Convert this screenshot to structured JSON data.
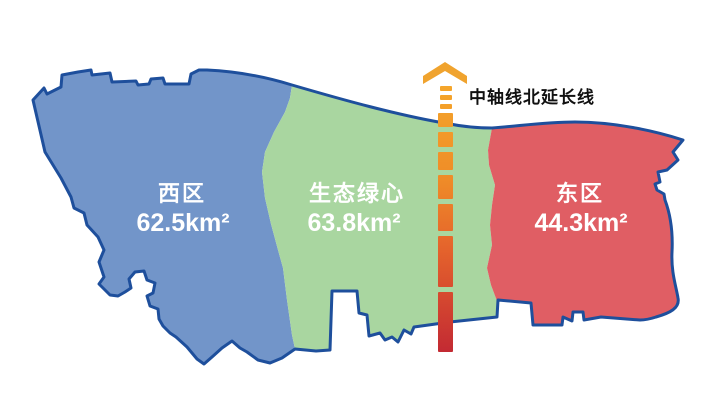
{
  "map_title": "district-area-map",
  "regions": {
    "west": {
      "name": "西区",
      "area": "62.5km²",
      "fill": "#7295C9"
    },
    "center": {
      "name": "生态绿心",
      "area": "63.8km²",
      "fill": "#A9D6A0"
    },
    "east": {
      "name": "东区",
      "area": "44.3km²",
      "fill": "#E05E64"
    }
  },
  "axis": {
    "label": "中轴线北延长线",
    "label_color": "#111111",
    "arrow_color": "#F0A32E",
    "gradient": {
      "top": "#F5A62B",
      "upper_mid": "#EF8C28",
      "lower_mid": "#E4622C",
      "bottom": "#C32A33"
    }
  },
  "outline_color": "#1E4F9C",
  "region_label_color": "#FFFFFF",
  "background_color": "#FFFFFF"
}
